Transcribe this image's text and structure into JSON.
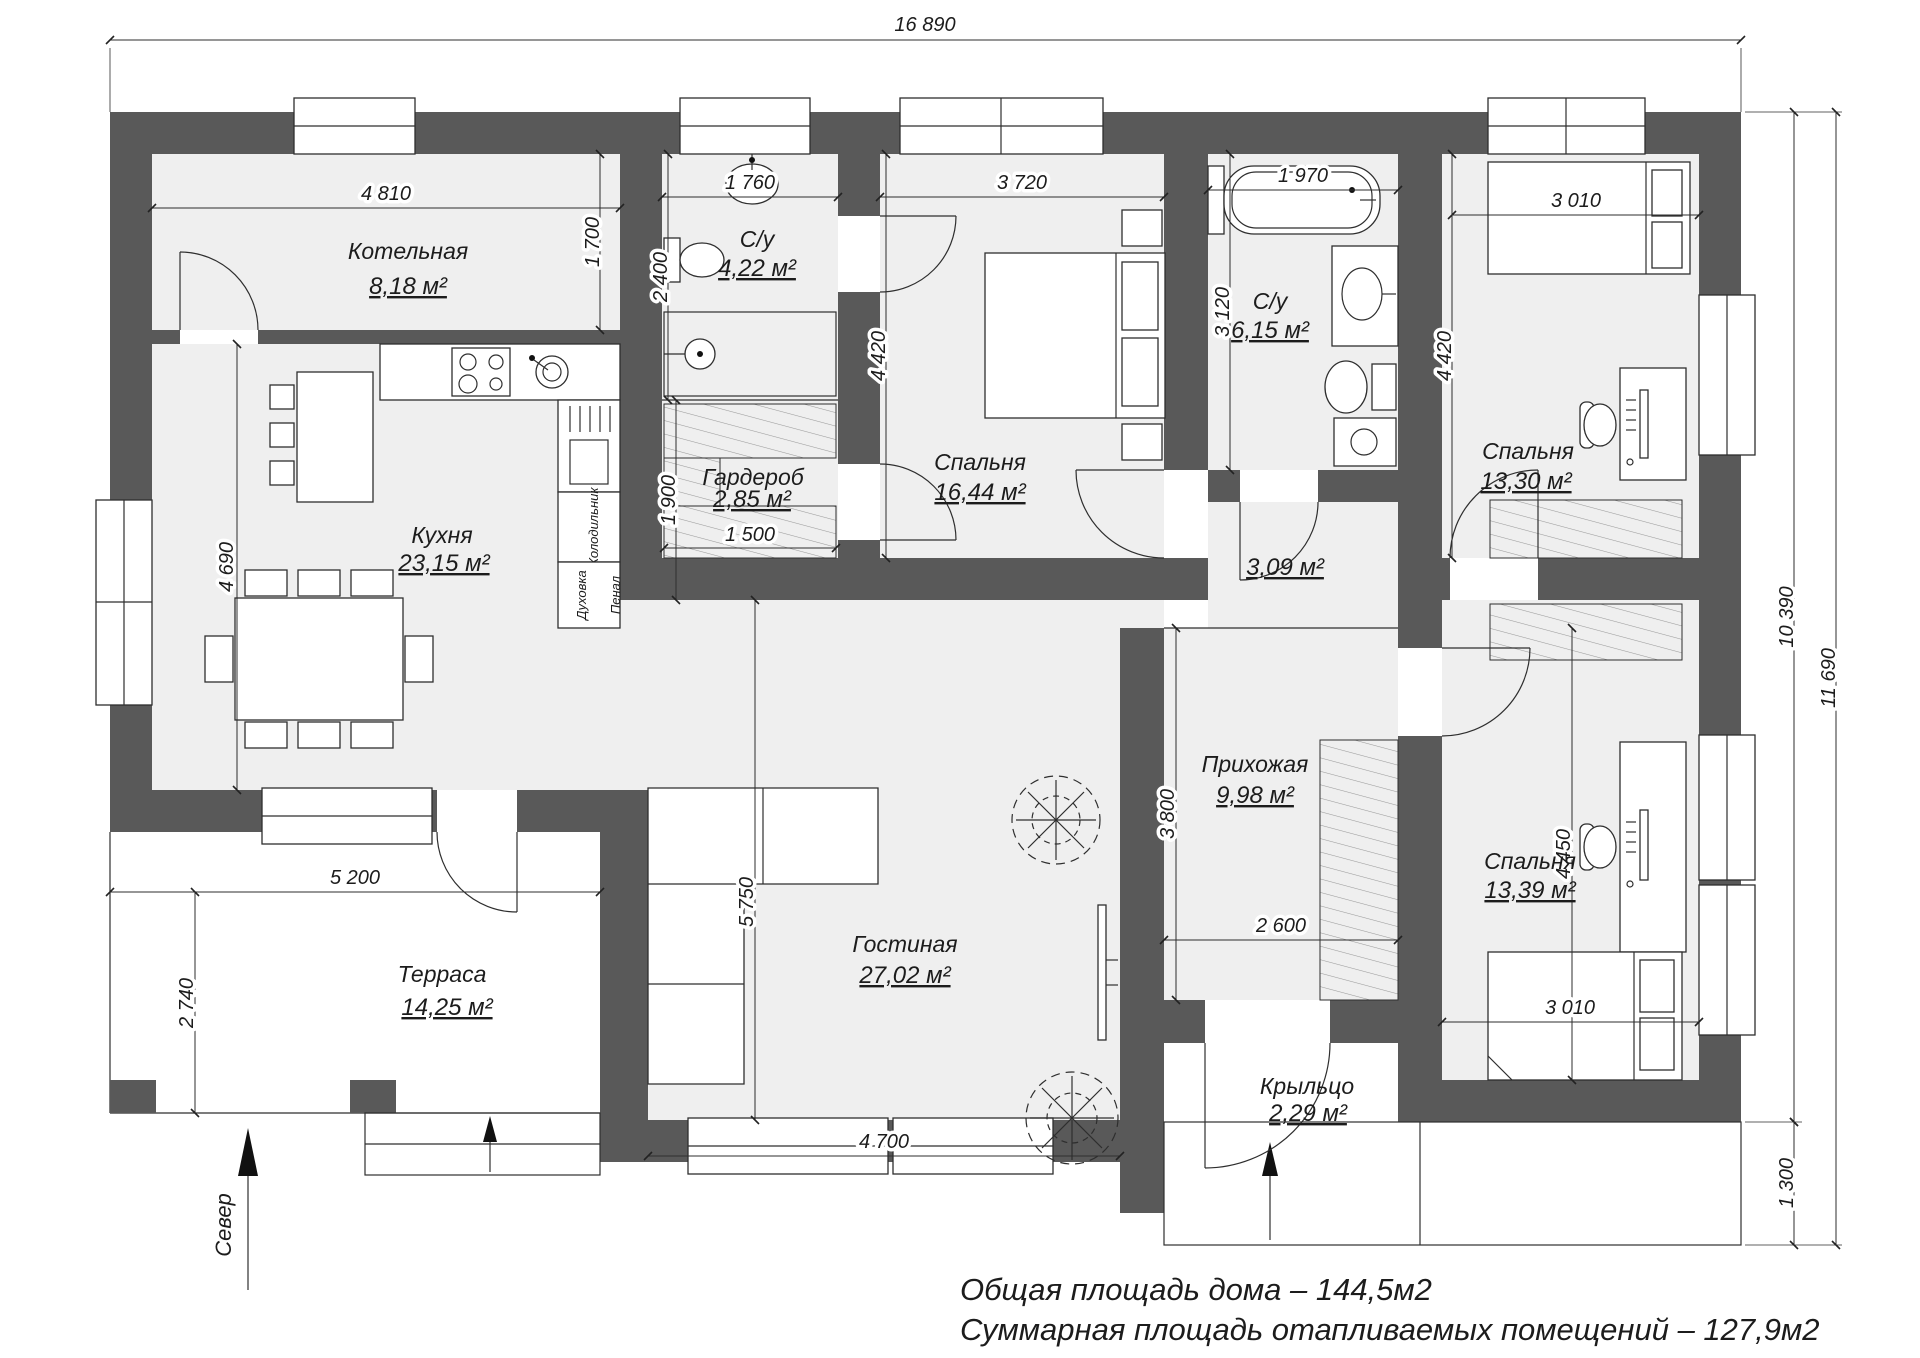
{
  "rooms": {
    "boiler": {
      "name": "Котельная",
      "area": "8,18 м²"
    },
    "bath1": {
      "name": "С/у",
      "area": "4,22 м²"
    },
    "bedroom1": {
      "name": "Спальня",
      "area": "16,44 м²"
    },
    "bath2": {
      "name": "С/у",
      "area": "6,15 м²"
    },
    "bedroom2": {
      "name": "Спальня",
      "area": "13,30 м²"
    },
    "kitchen": {
      "name": "Кухня",
      "area": "23,15 м²"
    },
    "wardrobe": {
      "name": "Гардероб",
      "area": "2,85 м²"
    },
    "hall": {
      "area": "3,09 м²"
    },
    "entry": {
      "name": "Прихожая",
      "area": "9,98 м²"
    },
    "living": {
      "name": "Гостиная",
      "area": "27,02 м²"
    },
    "bedroom3": {
      "name": "Спальня",
      "area": "13,39 м²"
    },
    "terrace": {
      "name": "Терраса",
      "area": "14,25 м²"
    },
    "porch": {
      "name": "Крыльцо",
      "area": "2,29 м²"
    }
  },
  "dims": {
    "total_width": "16 890",
    "boiler_w": "4 810",
    "boiler_h": "1 700",
    "bath1_w": "1 760",
    "bath1_h": "2 400",
    "bedroom1_w": "3 720",
    "bedroom1_h": "4 420",
    "bath2_w": "1 970",
    "bath2_h": "3 120",
    "bedroom2_w": "3 010",
    "bedroom2_h": "4 420",
    "kitchen_h": "4 690",
    "wardrobe_h": "1 900",
    "wardrobe_w": "1 500",
    "terrace_w": "5 200",
    "terrace_h": "2 740",
    "living_h": "5 750",
    "living_w": "4 700",
    "entry_h": "3 800",
    "entry_w": "2 600",
    "bedroom3_h": "4 450",
    "bedroom3_w": "3 010",
    "side_inner": "10 390",
    "side_total": "11 690",
    "porch_h": "1 300"
  },
  "labels": {
    "north": "Север",
    "fridge": "Холодильник",
    "oven": "Духовка",
    "cupboard": "Пенал"
  },
  "summary": {
    "line1": "Общая площадь дома – 144,5м2",
    "line2": "Суммарная площадь отапливаемых помещений – 127,9м2"
  }
}
